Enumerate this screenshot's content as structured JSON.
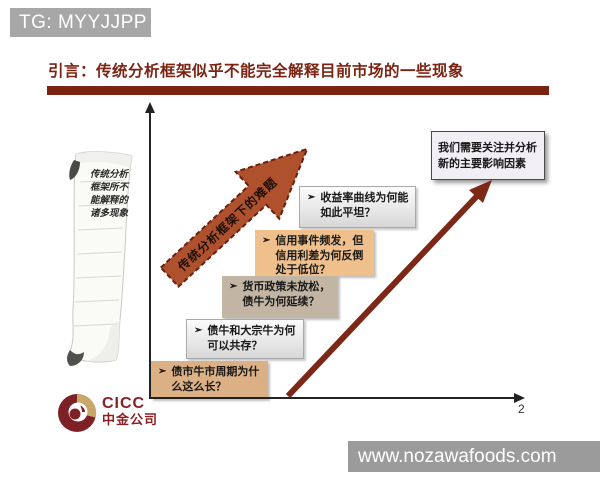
{
  "header": {
    "tg_label": "TG: MYYJJPP"
  },
  "title": {
    "text": "引言：传统分析框架似乎不能完全解释目前市场的一些现象"
  },
  "scroll": {
    "lines": [
      "传统分析",
      "框架所不",
      "能解释的",
      "诸多现象"
    ]
  },
  "diagonal_arrow": {
    "label": "传统分析框架下的难题"
  },
  "questions": [
    {
      "bullet": "➢",
      "text": "收益率曲线为何能如此平坦？"
    },
    {
      "bullet": "➢",
      "text": "信用事件频发，但信用利差为何反倒处于低位？"
    },
    {
      "bullet": "➢",
      "text": "货币政策未放松，债牛为何延续？"
    },
    {
      "bullet": "➢",
      "text": "债牛和大宗牛为何可以共存？"
    },
    {
      "bullet": "➢",
      "text": "债市牛市周期为什么这么长？"
    }
  ],
  "conclusion_box": {
    "text": "我们需要关注并分析新的主要影响因素"
  },
  "page_number": "2",
  "logo": {
    "en": "CICC",
    "cn": "中金公司"
  },
  "watermark": {
    "text": "www.nozawafoods.com"
  },
  "colors": {
    "title_red": "#7b2413",
    "rule_red": "#7a2311",
    "big_arrow": "#7d2817",
    "diagonal_arrow_fill": "#b0512d",
    "diagonal_arrow_border": "#6b1e0e",
    "peach_box": "#efc08c",
    "taupe_box": "#c2b5a3",
    "tan_box": "#dbb084",
    "gray_bar": "#a7a7a7",
    "watermark_bar": "#9b9b9b",
    "logo_maroon": "#7e2127",
    "logo_gold": "#c8a76a"
  }
}
